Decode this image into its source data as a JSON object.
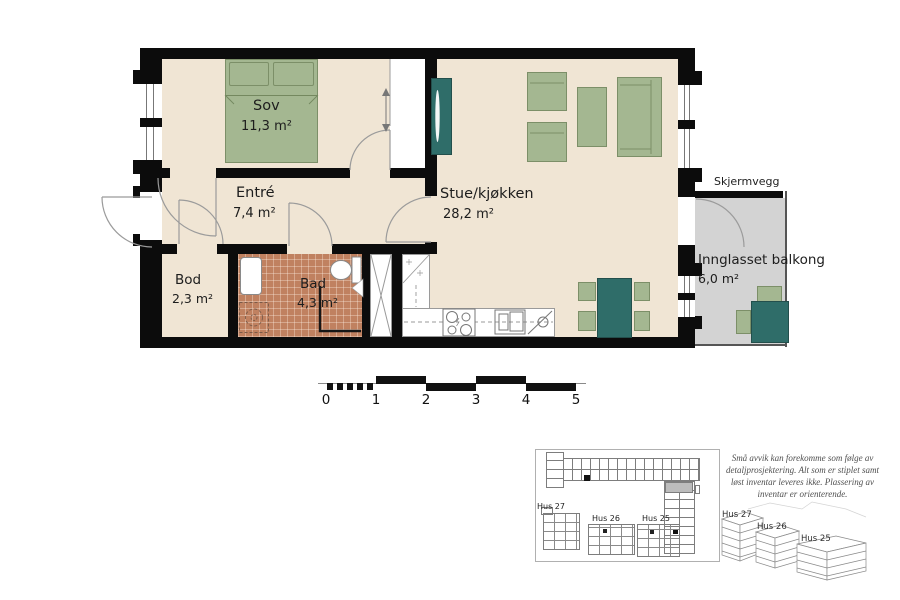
{
  "rooms": {
    "sov": {
      "name": "Sov",
      "area": "11,3 m²"
    },
    "entre": {
      "name": "Entré",
      "area": "7,4 m²"
    },
    "stue": {
      "name": "Stue/kjøkken",
      "area": "28,2 m²"
    },
    "bod": {
      "name": "Bod",
      "area": "2,3 m²"
    },
    "bad": {
      "name": "Bad",
      "area": "4,3 m²"
    },
    "balkong": {
      "name": "Innglasset balkong",
      "area": "6,0 m²"
    }
  },
  "annotations": {
    "skjermvegg": "Skjermvegg",
    "north_label": "N"
  },
  "scale_bar": {
    "labels": [
      "0",
      "1",
      "2",
      "3",
      "4",
      "5"
    ]
  },
  "site_plan": {
    "buildings": [
      {
        "label": "Hus 27"
      },
      {
        "label": "Hus 26"
      },
      {
        "label": "Hus 25"
      }
    ]
  },
  "buildings_3d": [
    {
      "label": "Hus 27"
    },
    {
      "label": "Hus 26"
    },
    {
      "label": "Hus 25"
    }
  ],
  "disclaimer_lines": [
    "Små avvik kan forekomme som følge av",
    "detaljprosjektering. Alt som er stiplet samt",
    "løst inventar leveres ikke. Plassering av",
    "inventar er orienterende."
  ],
  "colors": {
    "wall": "#0c0c0c",
    "floor": "#f0e5d4",
    "bath_tile": "#c08160",
    "balcony": "#d3d3d3",
    "green": "#a4b791",
    "green_dark": "#7c8f68",
    "teal": "#2f6d69",
    "teal_dark": "#234f4c",
    "outline_gray": "#9a9a9a"
  }
}
